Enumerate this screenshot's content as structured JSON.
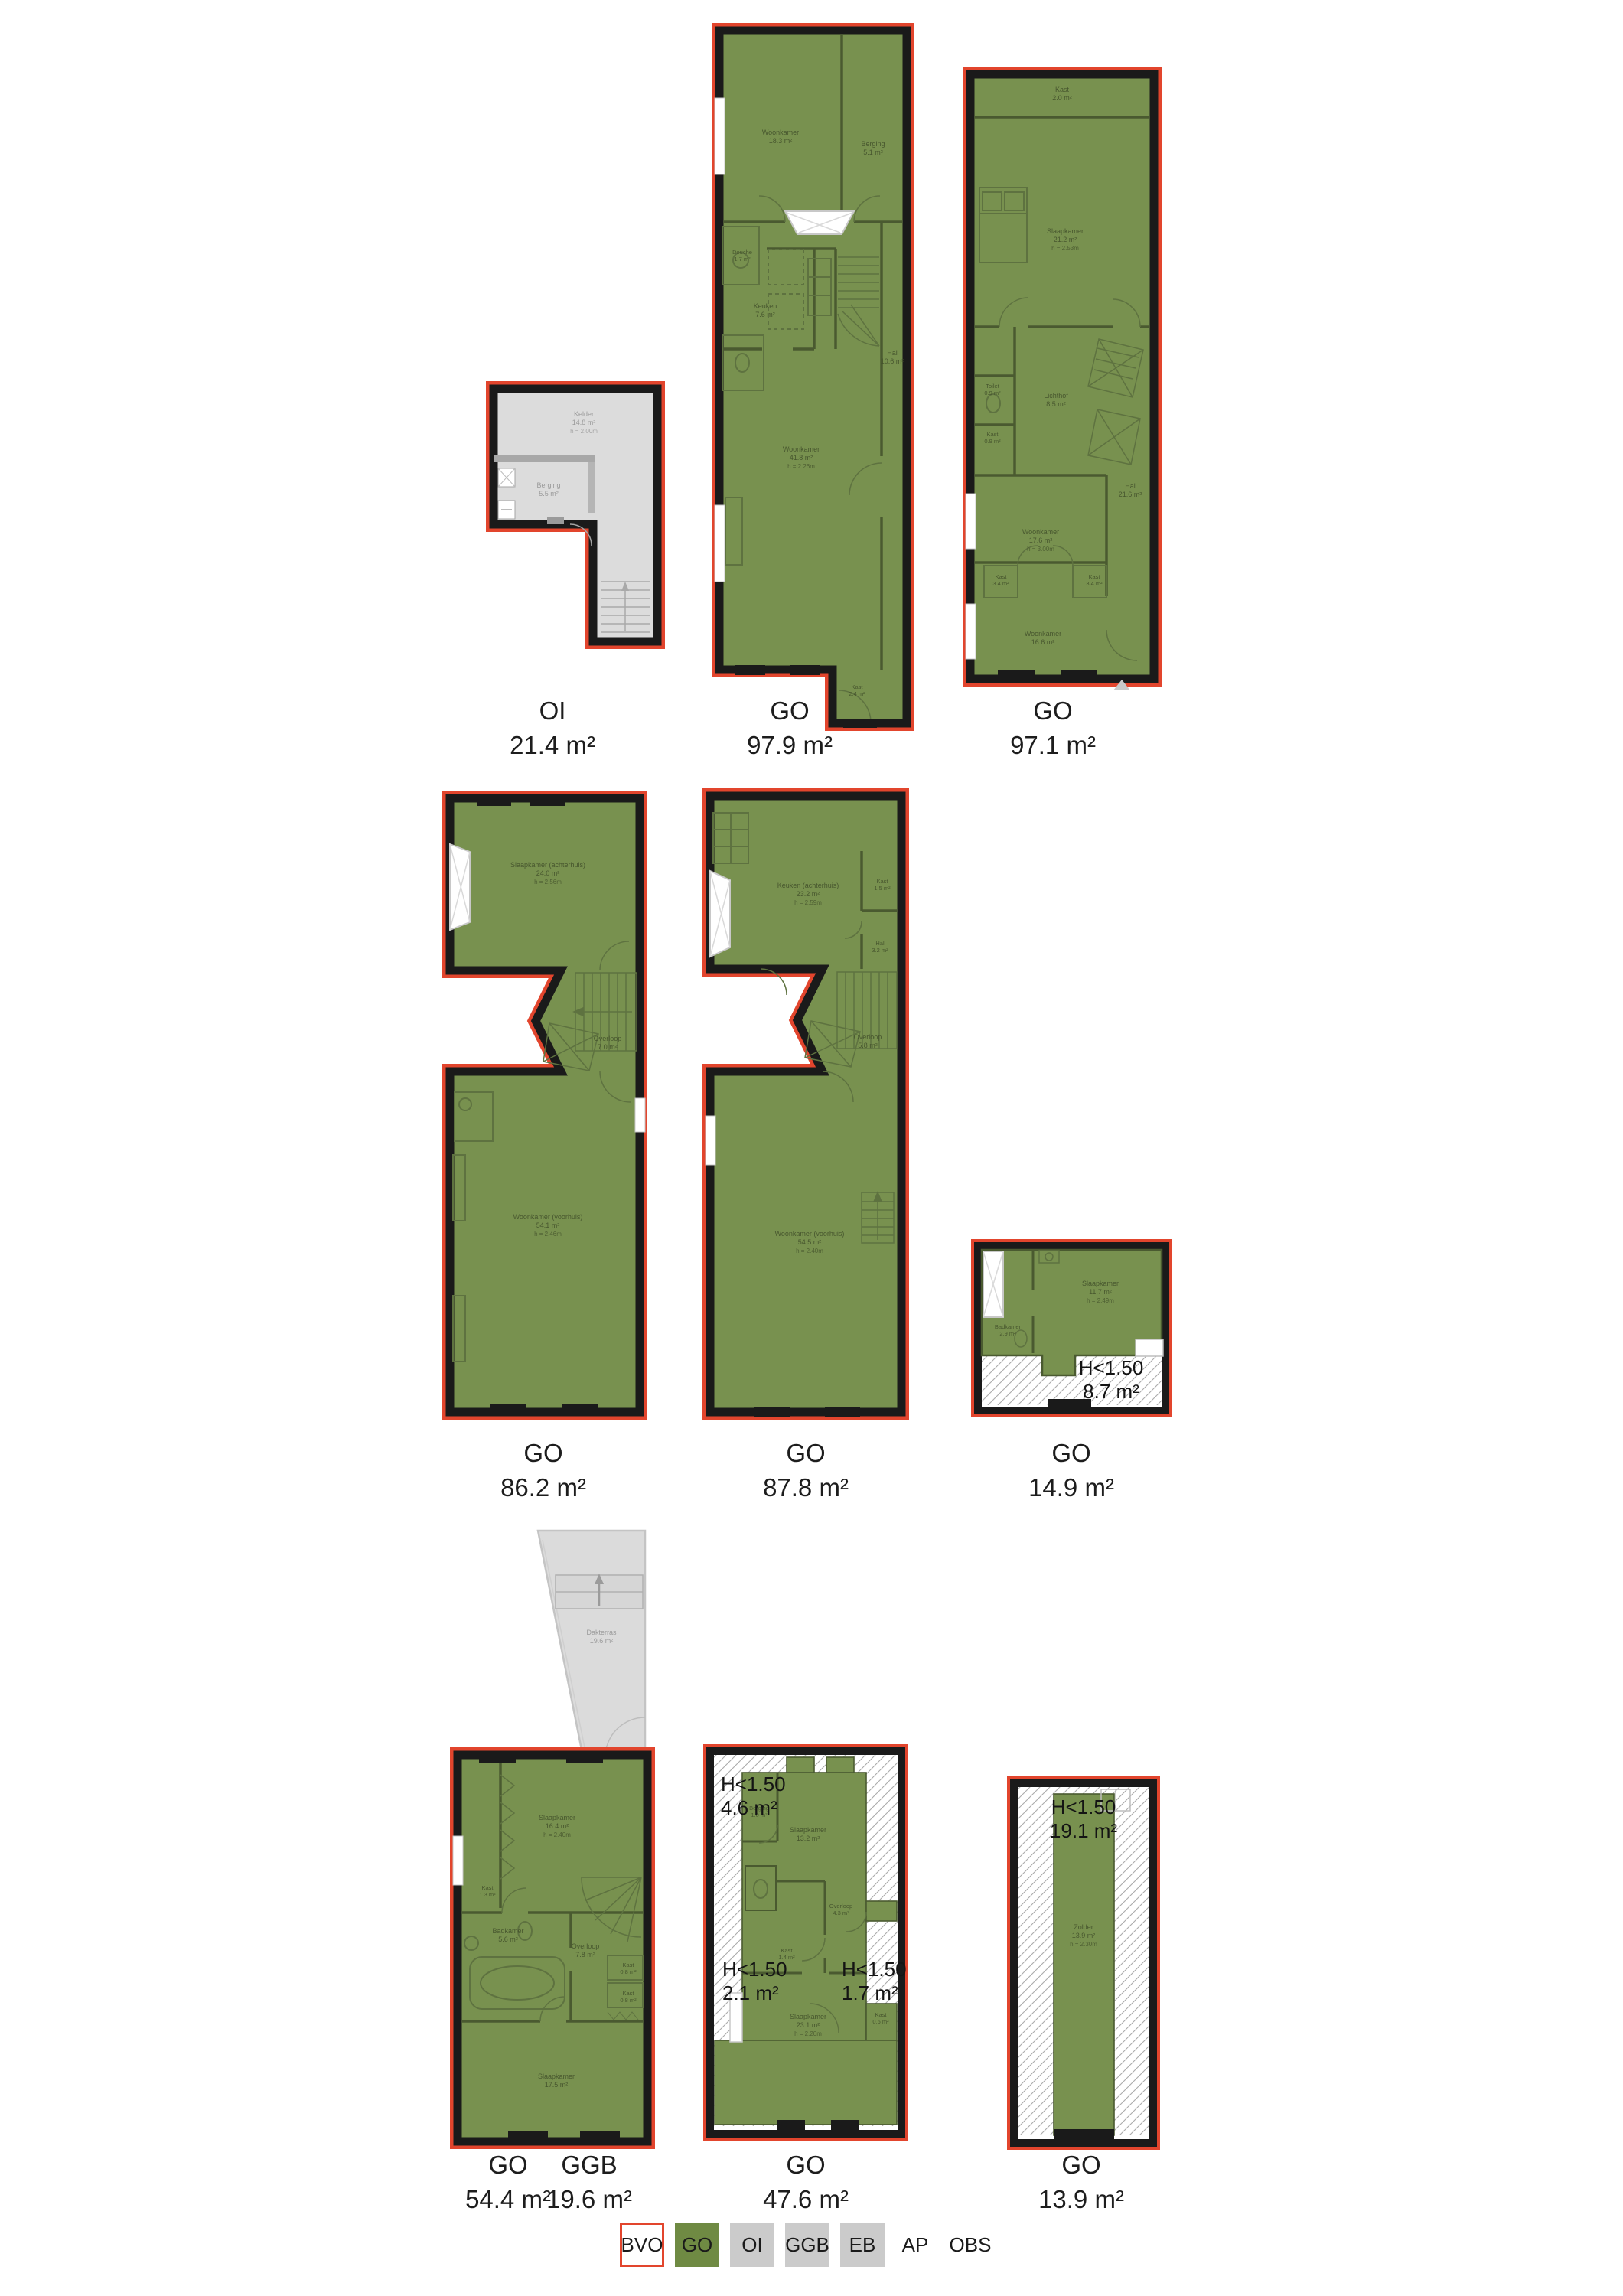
{
  "plans": {
    "oi": {
      "type": "OI",
      "area": "21.4 m²",
      "rooms": {
        "kelder": {
          "name": "Kelder",
          "area": "14.8 m²",
          "h": "h = 2.00m"
        },
        "berging": {
          "name": "Berging",
          "area": "5.5 m²"
        }
      }
    },
    "go979": {
      "type": "GO",
      "area": "97.9 m²",
      "rooms": {
        "woonkamer_boven": {
          "name": "Woonkamer",
          "area": "18.3 m²"
        },
        "berging": {
          "name": "Berging",
          "area": "5.1 m²"
        },
        "douche": {
          "name": "Douche",
          "area": "1.7 m²"
        },
        "keuken": {
          "name": "Keuken",
          "area": "7.6 m²"
        },
        "woonkamer": {
          "name": "Woonkamer",
          "area": "41.8 m²",
          "h": "h = 2.26m"
        },
        "hal": {
          "name": "Hal",
          "area": "10.6 m²"
        },
        "kast": {
          "name": "Kast",
          "area": "2.4 m²"
        }
      }
    },
    "go971": {
      "type": "GO",
      "area": "97.1 m²",
      "rooms": {
        "kast_boven": {
          "name": "Kast",
          "area": "2.0 m²"
        },
        "slaapkamer": {
          "name": "Slaapkamer",
          "area": "21.2 m²",
          "h": "h = 2.53m"
        },
        "toilet": {
          "name": "Toilet",
          "area": "0.9 m²"
        },
        "kast_klein": {
          "name": "Kast",
          "area": "0.9 m²"
        },
        "lichthof": {
          "name": "Lichthof",
          "area": "8.5 m²"
        },
        "woonkamer_midden": {
          "name": "Woonkamer",
          "area": "17.6 m²",
          "h": "h = 3.00m"
        },
        "kast_links": {
          "name": "Kast",
          "area": "3.4 m²"
        },
        "kast_rechts": {
          "name": "Kast",
          "area": "3.4 m²"
        },
        "woonkamer_voor": {
          "name": "Woonkamer",
          "area": "16.6 m²"
        },
        "hal": {
          "name": "Hal",
          "area": "21.6 m²"
        }
      }
    },
    "go862": {
      "type": "GO",
      "area": "86.2 m²",
      "rooms": {
        "slaapkamer": {
          "name": "Slaapkamer (achterhuis)",
          "area": "24.0 m²",
          "h": "h = 2.56m"
        },
        "overloop": {
          "name": "Overloop",
          "area": "7.0 m²"
        },
        "woonkamer": {
          "name": "Woonkamer (voorhuis)",
          "area": "54.1 m²",
          "h": "h = 2.46m"
        }
      }
    },
    "go878": {
      "type": "GO",
      "area": "87.8 m²",
      "rooms": {
        "keuken": {
          "name": "Keuken (achterhuis)",
          "area": "23.2 m²",
          "h": "h = 2.59m"
        },
        "kast": {
          "name": "Kast",
          "area": "1.5 m²"
        },
        "hal": {
          "name": "Hal",
          "area": "3.2 m²"
        },
        "overloop": {
          "name": "Overloop",
          "area": "5.8 m²"
        },
        "woonkamer": {
          "name": "Woonkamer (voorhuis)",
          "area": "54.5 m²",
          "h": "h = 2.40m"
        }
      }
    },
    "go149": {
      "type": "GO",
      "area": "14.9 m²",
      "rooms": {
        "slaapkamer": {
          "name": "Slaapkamer",
          "area": "11.7 m²",
          "h": "h = 2.49m"
        },
        "badkamer": {
          "name": "Badkamer",
          "area": "2.9 m²"
        }
      },
      "overlays": {
        "h150": {
          "l1": "H<1.50",
          "l2": "8.7 m²"
        }
      }
    },
    "ggb": {
      "type": "GGB",
      "area": "19.6 m²",
      "rooms": {
        "dakterras": {
          "name": "Dakterras",
          "area": "19.6 m²"
        }
      }
    },
    "go544": {
      "type": "GO",
      "area": "54.4 m²",
      "rooms": {
        "kast": {
          "name": "Kast",
          "area": "1.3 m²"
        },
        "slaapkamer_achter": {
          "name": "Slaapkamer",
          "area": "16.4 m²",
          "h": "h = 2.40m"
        },
        "badkamer": {
          "name": "Badkamer",
          "area": "5.6 m²"
        },
        "overloop": {
          "name": "Overloop",
          "area": "7.8 m²"
        },
        "kast_a": {
          "name": "Kast",
          "area": "0.8 m²"
        },
        "kast_b": {
          "name": "Kast",
          "area": "0.8 m²"
        },
        "slaapkamer_voor": {
          "name": "Slaapkamer",
          "area": "17.5 m²"
        }
      }
    },
    "go476": {
      "type": "GO",
      "area": "47.6 m²",
      "rooms": {
        "berging": {
          "name": "Berging",
          "area": "1.0 m²"
        },
        "slaapkamer_boven": {
          "name": "Slaapkamer",
          "area": "13.2 m²"
        },
        "overloop": {
          "name": "Overloop",
          "area": "4.3 m²"
        },
        "kast": {
          "name": "Kast",
          "area": "1.4 m²"
        },
        "slaapkamer": {
          "name": "Slaapkamer",
          "area": "23.1 m²",
          "h": "h = 2.20m"
        },
        "kast_klein": {
          "name": "Kast",
          "area": "0.6 m²"
        }
      },
      "overlays": {
        "h150_a": {
          "l1": "H<1.50",
          "l2": "4.6 m²"
        },
        "h150_b": {
          "l1": "H<1.50",
          "l2": "2.1 m²"
        },
        "h150_c": {
          "l1": "H<1.50",
          "l2": "1.7 m²"
        }
      }
    },
    "go139": {
      "type": "GO",
      "area": "13.9 m²",
      "rooms": {
        "zolder": {
          "name": "Zolder",
          "area": "13.9 m²",
          "h": "h = 2.30m"
        }
      },
      "overlays": {
        "h150": {
          "l1": "H<1.50",
          "l2": "19.1 m²"
        }
      }
    }
  },
  "legend": {
    "items": [
      {
        "label": "BVO"
      },
      {
        "label": "GO"
      },
      {
        "label": "OI"
      },
      {
        "label": "GGB"
      },
      {
        "label": "EB"
      },
      {
        "label": "AP"
      },
      {
        "label": "OBS"
      }
    ]
  },
  "colors": {
    "go_fill": "#78914f",
    "wall": "#1a1a1a",
    "outline_red": "#e2452d",
    "oi_fill": "#dcdcdc",
    "terrace_fill": "#dbdbdb",
    "legend_gray": "#cbcbcb"
  }
}
